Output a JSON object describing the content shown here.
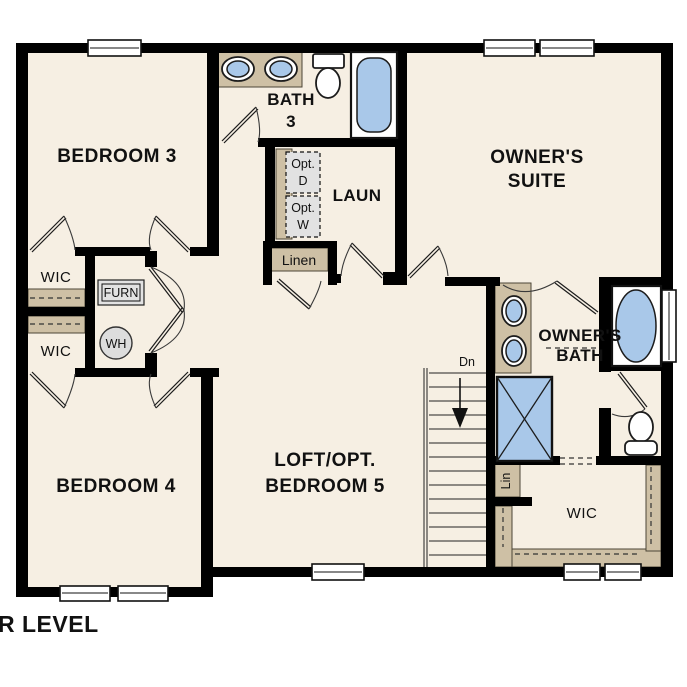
{
  "palette": {
    "background": "#ffffff",
    "floor": "#f6efe3",
    "wall": "#000000",
    "counter_tan": "#cec0a5",
    "fixture_blue": "#a9c8e9",
    "fixture_gray": "#e2e2e2",
    "text": "#111111"
  },
  "title": "UPPER LEVEL",
  "rooms": {
    "bedroom3": {
      "label": "BEDROOM 3"
    },
    "bath3": {
      "line1": "BATH",
      "line2": "3"
    },
    "laundry": {
      "label": "LAUN"
    },
    "owners_suite": {
      "line1": "OWNER'S",
      "line2": "SUITE"
    },
    "owners_bath": {
      "line1": "OWNER'S",
      "line2": "BATH"
    },
    "wic_upper_left": {
      "label": "WIC"
    },
    "wic_lower_left": {
      "label": "WIC"
    },
    "bedroom4": {
      "label": "BEDROOM 4"
    },
    "loft": {
      "line1": "LOFT/OPT.",
      "line2": "BEDROOM 5"
    },
    "owners_wic": {
      "label": "WIC"
    }
  },
  "fixtures": {
    "furnace": {
      "label": "FURN"
    },
    "water_heater": {
      "label": "WH"
    },
    "linen_closet": {
      "label": "Linen"
    },
    "linen_cubby": {
      "label": "Lin"
    },
    "optional_dryer": {
      "line1": "Opt.",
      "line2": "D"
    },
    "optional_washer": {
      "line1": "Opt.",
      "line2": "W"
    },
    "stairs_direction": {
      "label": "Dn"
    }
  }
}
